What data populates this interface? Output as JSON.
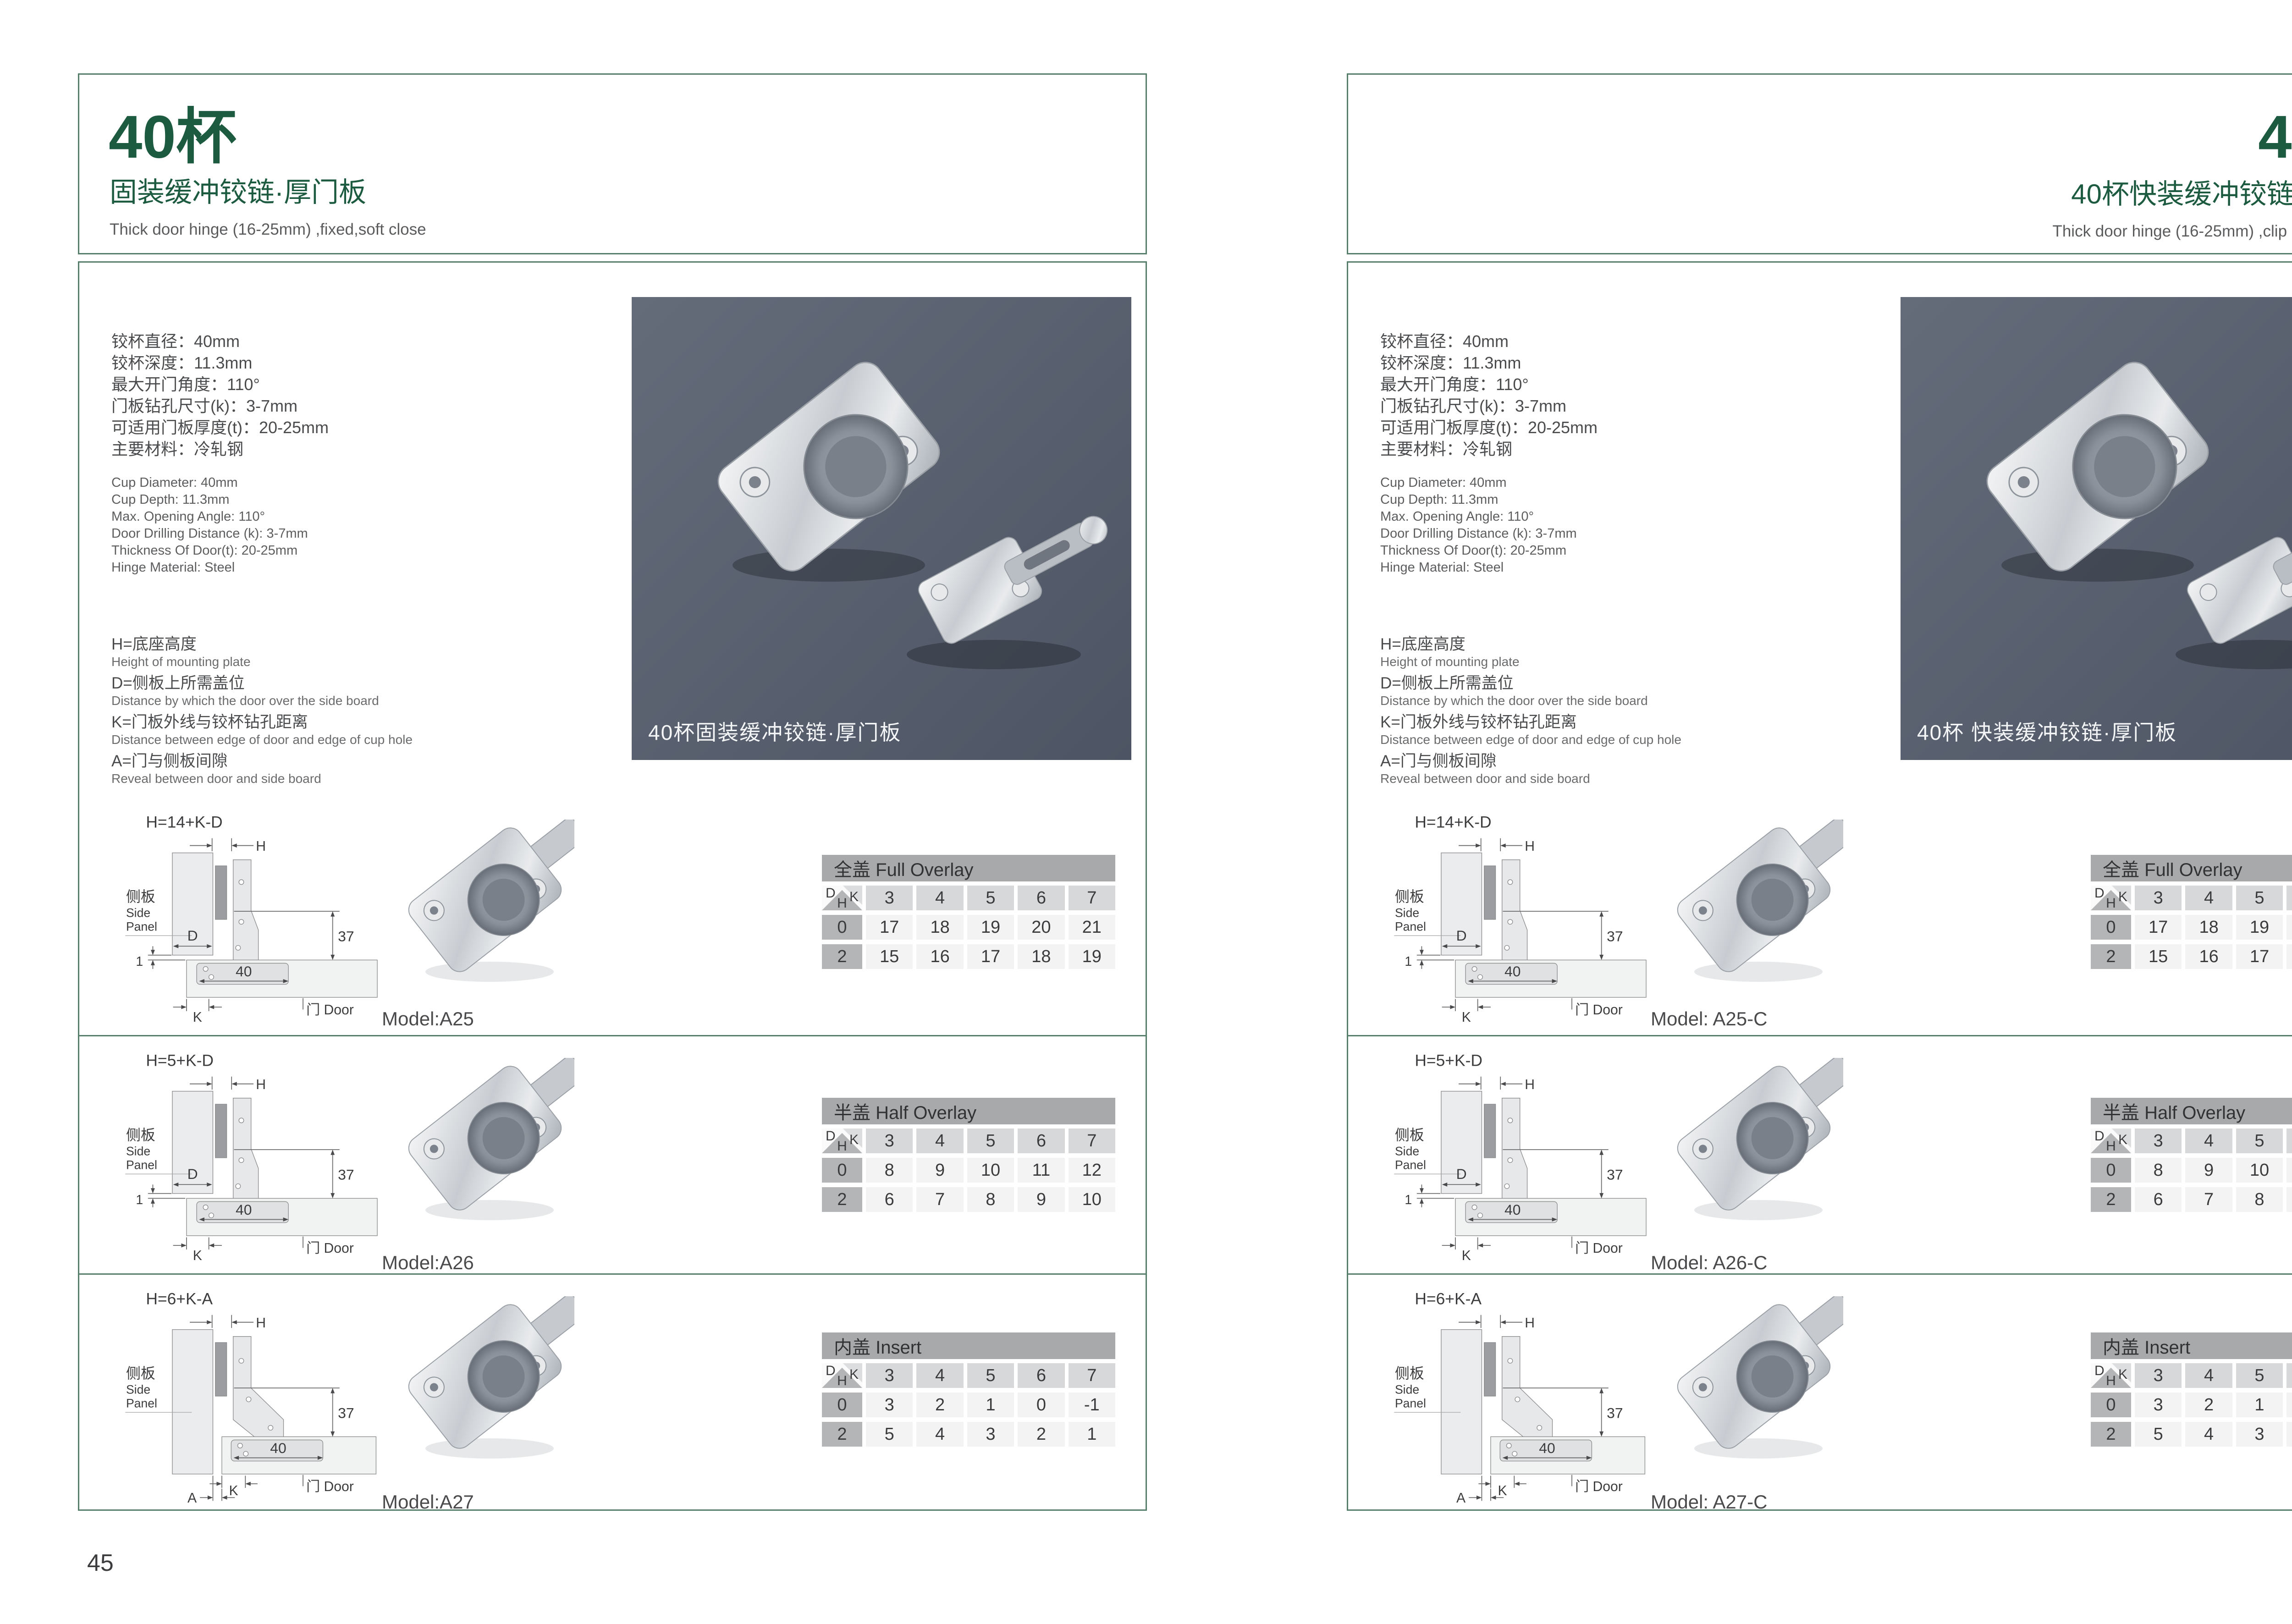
{
  "accent_green": "#1d5b41",
  "pages": [
    {
      "side": "left",
      "page_number": "45",
      "title": "40杯",
      "subtitle": "固装缓冲铰链·厚门板",
      "subtitle_en": "Thick door hinge (16-25mm)  ,fixed,soft close",
      "photo_caption": "40杯固装缓冲铰链·厚门板",
      "models": [
        "Model:A25",
        "Model:A26",
        "Model:A27"
      ],
      "formulas": [
        "H=14+K-D",
        "H=5+K-D",
        "H=6+K-A"
      ]
    },
    {
      "side": "right",
      "page_number": "46",
      "title": "40杯",
      "subtitle": "40杯快装缓冲铰链·厚门板",
      "subtitle_en": "Thick door hinge (16-25mm)  ,clip on ,soft close",
      "photo_caption": "40杯 快装缓冲铰链·厚门板",
      "models": [
        "Model: A25-C",
        "Model: A26-C",
        "Model: A27-C"
      ],
      "formulas": [
        "H=14+K-D",
        "H=5+K-D",
        "H=6+K-A"
      ]
    }
  ],
  "specs_cn": [
    "铰杯直径：40mm",
    "铰杯深度：11.3mm",
    "最大开门角度：110°",
    "门板钻孔尺寸(k)：3-7mm",
    "可适用门板厚度(t)：20-25mm",
    "主要材料：冷轧钢"
  ],
  "specs_en": [
    "Cup Diameter: 40mm",
    "Cup Depth: 11.3mm",
    "Max. Opening Angle: 110°",
    "Door Drilling Distance (k): 3-7mm",
    "Thickness Of Door(t): 20-25mm",
    "Hinge Material: Steel"
  ],
  "definitions": [
    {
      "cn": "H=底座高度",
      "en": "Height of mounting plate"
    },
    {
      "cn": "D=侧板上所需盖位",
      "en": "Distance by which the door over the side board"
    },
    {
      "cn": "K=门板外线与铰杯钻孔距离",
      "en": "Distance between edge of door and edge of cup hole"
    },
    {
      "cn": "A=门与侧板间隙",
      "en": "Reveal between door and side board"
    }
  ],
  "diagram_labels": {
    "h": "H",
    "side_cn": "侧板",
    "side_en_1": "Side",
    "side_en_2": "Panel",
    "d": "D",
    "dim_37": "37",
    "dim_1": "1",
    "dim_40": "40",
    "k": "K",
    "a": "A",
    "door": "门 Door"
  },
  "tables": [
    {
      "title": "全盖 Full Overlay",
      "corner": {
        "d": "D",
        "k": "K",
        "h": "H"
      },
      "columns": [
        "3",
        "4",
        "5",
        "6",
        "7"
      ],
      "rows": [
        {
          "h": "0",
          "values": [
            "17",
            "18",
            "19",
            "20",
            "21"
          ]
        },
        {
          "h": "2",
          "values": [
            "15",
            "16",
            "17",
            "18",
            "19"
          ]
        }
      ]
    },
    {
      "title": "半盖 Half Overlay",
      "corner": {
        "d": "D",
        "k": "K",
        "h": "H"
      },
      "columns": [
        "3",
        "4",
        "5",
        "6",
        "7"
      ],
      "rows": [
        {
          "h": "0",
          "values": [
            "8",
            "9",
            "10",
            "11",
            "12"
          ]
        },
        {
          "h": "2",
          "values": [
            "6",
            "7",
            "8",
            "9",
            "10"
          ]
        }
      ]
    },
    {
      "title": "内盖 Insert",
      "corner": {
        "d": "D",
        "k": "K",
        "h": "H"
      },
      "columns": [
        "3",
        "4",
        "5",
        "6",
        "7"
      ],
      "rows": [
        {
          "h": "0",
          "values": [
            "3",
            "2",
            "1",
            "0",
            "-1"
          ]
        },
        {
          "h": "2",
          "values": [
            "5",
            "4",
            "3",
            "2",
            "1"
          ]
        }
      ]
    }
  ]
}
